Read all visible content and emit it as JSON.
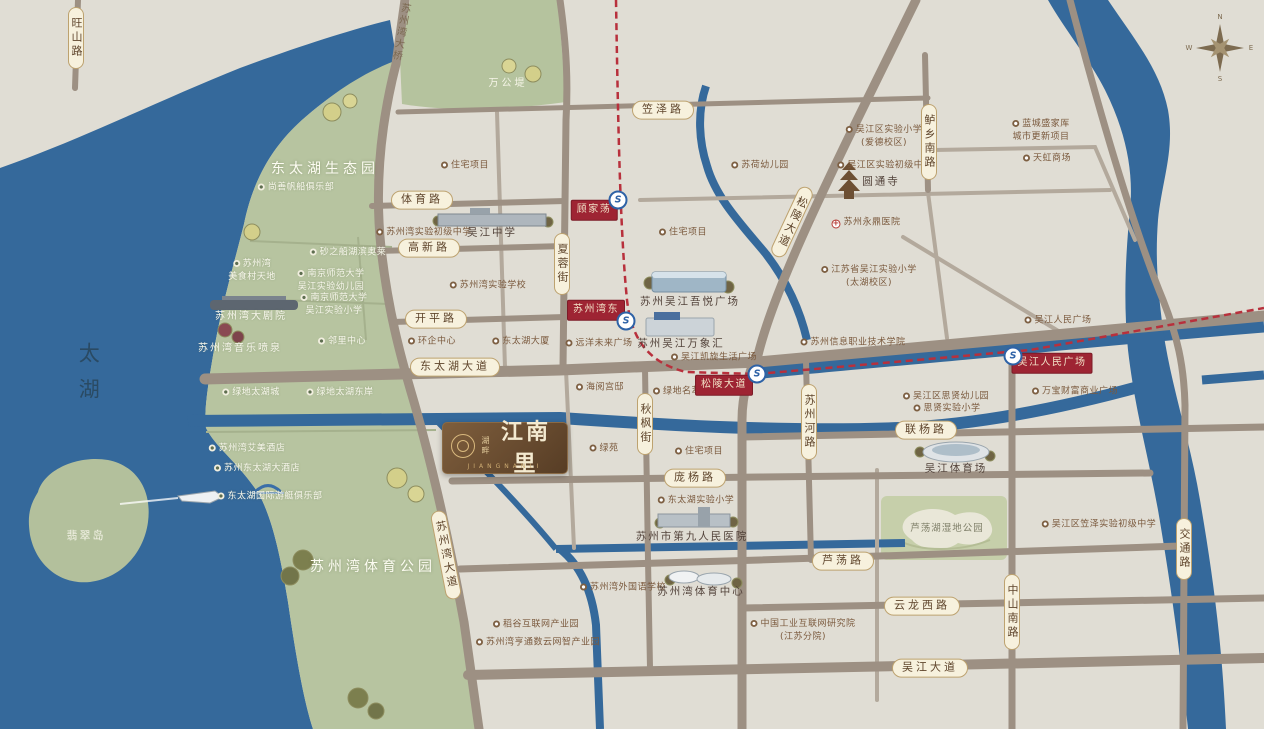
{
  "brand": {
    "prefix": "湖畔",
    "name": "江南里",
    "latin": "JIANGNANLI"
  },
  "compass": {
    "n": "N",
    "e": "E",
    "s": "S",
    "w": "W"
  },
  "colors": {
    "water": "#35699b",
    "land": "#e0ddd4",
    "greenbelt": "#b7c4a0",
    "road": "#9d9083",
    "capsule_bg": "#f7f1dd",
    "badge_red": "#9e2433",
    "metro_blue": "#2e62a6",
    "metro_line_red": "#b8303c",
    "logo_brown": "#6a4c2f"
  },
  "map": {
    "road_capsules": [
      {
        "t": "旺山路",
        "x": 76,
        "y": 38,
        "cls": "v"
      },
      {
        "t": "苏州湾大桥",
        "x": 399,
        "y": 32,
        "cls": "v plain",
        "rot": 10
      },
      {
        "t": "笠泽路",
        "x": 663,
        "y": 110
      },
      {
        "t": "体育路",
        "x": 422,
        "y": 200
      },
      {
        "t": "高新路",
        "x": 429,
        "y": 248
      },
      {
        "t": "开平路",
        "x": 436,
        "y": 319
      },
      {
        "t": "东太湖大道",
        "x": 455,
        "y": 367
      },
      {
        "t": "夏蓉街",
        "x": 562,
        "y": 264,
        "cls": "v"
      },
      {
        "t": "秋枫街",
        "x": 645,
        "y": 424,
        "cls": "v"
      },
      {
        "t": "苏州湾大道",
        "x": 446,
        "y": 555,
        "cls": "v",
        "rot": -11
      },
      {
        "t": "松陵大道",
        "x": 792,
        "y": 222,
        "cls": "v",
        "rot": 25
      },
      {
        "t": "鲈乡南路",
        "x": 929,
        "y": 142,
        "cls": "v"
      },
      {
        "t": "苏州河路",
        "x": 809,
        "y": 422,
        "cls": "v"
      },
      {
        "t": "联杨路",
        "x": 926,
        "y": 430
      },
      {
        "t": "庞杨路",
        "x": 695,
        "y": 478
      },
      {
        "t": "芦荡路",
        "x": 843,
        "y": 561
      },
      {
        "t": "云龙西路",
        "x": 922,
        "y": 606
      },
      {
        "t": "吴江大道",
        "x": 930,
        "y": 668
      },
      {
        "t": "中山南路",
        "x": 1012,
        "y": 612,
        "cls": "v"
      },
      {
        "t": "交通路",
        "x": 1184,
        "y": 549,
        "cls": "v"
      }
    ],
    "metro_stations": [
      {
        "t": "顾家荡",
        "x": 594,
        "y": 210
      },
      {
        "t": "苏州湾东",
        "x": 596,
        "y": 310
      },
      {
        "t": "松陵大道",
        "x": 724,
        "y": 385
      },
      {
        "t": "吴江人民广场",
        "x": 1052,
        "y": 363
      }
    ],
    "metro_icons": [
      {
        "t": "S",
        "x": 618,
        "y": 200
      },
      {
        "t": "S",
        "x": 626,
        "y": 321
      },
      {
        "t": "S",
        "x": 757,
        "y": 374
      },
      {
        "t": "S",
        "x": 1013,
        "y": 356
      }
    ],
    "area_labels": [
      {
        "t": "东太湖生态园",
        "x": 325,
        "y": 169,
        "cls": "big"
      },
      {
        "t": "苏州湾体育公园",
        "x": 373,
        "y": 567,
        "cls": "big"
      },
      {
        "t": "万公堤",
        "x": 508,
        "y": 84,
        "cls": "midw"
      },
      {
        "t": "太湖",
        "x": 88,
        "y": 378,
        "cls": "lake-label"
      },
      {
        "t": "翡翠岛",
        "x": 86,
        "y": 536,
        "cls": "island"
      },
      {
        "t": "芦荡湖湿地公园",
        "x": 947,
        "y": 529,
        "cls": "parktext"
      }
    ],
    "pois": [
      {
        "t": "尚善帆船俱乐部",
        "x": 296,
        "y": 188,
        "cls": "w"
      },
      {
        "t": "苏州湾\n美食村天地",
        "x": 252,
        "y": 271,
        "cls": "w"
      },
      {
        "t": "砂之船湖滨奥莱",
        "x": 348,
        "y": 253,
        "cls": "w"
      },
      {
        "t": "南京师范大学\n吴江实验幼儿园",
        "x": 331,
        "y": 281,
        "cls": "w"
      },
      {
        "t": "南京师范大学\n吴江实验小学",
        "x": 334,
        "y": 305,
        "cls": "w"
      },
      {
        "t": "苏州湾大剧院",
        "x": 251,
        "y": 317,
        "cls": "w nodot md"
      },
      {
        "t": "苏州湾音乐喷泉",
        "x": 240,
        "y": 349,
        "cls": "w nodot md"
      },
      {
        "t": "邻里中心",
        "x": 342,
        "y": 342,
        "cls": "w"
      },
      {
        "t": "绿地太湖城",
        "x": 251,
        "y": 393,
        "cls": "w"
      },
      {
        "t": "绿地太湖东岸",
        "x": 340,
        "y": 393,
        "cls": "w"
      },
      {
        "t": "苏州湾艾美酒店",
        "x": 247,
        "y": 449,
        "cls": "w"
      },
      {
        "t": "苏州东太湖大酒店",
        "x": 257,
        "y": 469,
        "cls": "w"
      },
      {
        "t": "东太湖国际游艇俱乐部",
        "x": 270,
        "y": 497,
        "cls": "w"
      },
      {
        "t": "住宅项目",
        "x": 465,
        "y": 166
      },
      {
        "t": "苏州湾实验初级中学",
        "x": 424,
        "y": 233
      },
      {
        "t": "吴江中学",
        "x": 492,
        "y": 233,
        "cls": "bldg nodot"
      },
      {
        "t": "苏州湾实验学校",
        "x": 488,
        "y": 286
      },
      {
        "t": "环企中心",
        "x": 432,
        "y": 342
      },
      {
        "t": "东太湖大厦",
        "x": 521,
        "y": 342
      },
      {
        "t": "住宅项目",
        "x": 683,
        "y": 233
      },
      {
        "t": "远洋未来广场",
        "x": 599,
        "y": 344
      },
      {
        "t": "苏荷幼儿园",
        "x": 760,
        "y": 166
      },
      {
        "t": "吴江区实验小学\n(爱德校区)",
        "x": 884,
        "y": 137
      },
      {
        "t": "吴江区实验初级中学",
        "x": 885,
        "y": 166
      },
      {
        "t": "圆通寺",
        "x": 881,
        "y": 182,
        "cls": "bldg nodot"
      },
      {
        "t": "苏州永鼎医院",
        "x": 866,
        "y": 223,
        "cls": "hosp"
      },
      {
        "t": "江苏省吴江实验小学\n(太湖校区)",
        "x": 869,
        "y": 277
      },
      {
        "t": "蓝城盛家厍\n城市更新项目",
        "x": 1041,
        "y": 131
      },
      {
        "t": "天虹商场",
        "x": 1047,
        "y": 159
      },
      {
        "t": "苏州吴江吾悦广场",
        "x": 690,
        "y": 302,
        "cls": "bldg nodot"
      },
      {
        "t": "苏州吴江万象汇",
        "x": 681,
        "y": 344,
        "cls": "bldg nodot"
      },
      {
        "t": "吴江凯旋生活广场",
        "x": 714,
        "y": 358
      },
      {
        "t": "苏州信息职业技术学院",
        "x": 853,
        "y": 343
      },
      {
        "t": "吴江人民广场",
        "x": 1058,
        "y": 321
      },
      {
        "t": "万宝财富商业广场",
        "x": 1075,
        "y": 392
      },
      {
        "t": "吴江区思贤幼儿园",
        "x": 946,
        "y": 397
      },
      {
        "t": "思贤实验小学",
        "x": 947,
        "y": 409
      },
      {
        "t": "海阅宫邸",
        "x": 600,
        "y": 388
      },
      {
        "t": "绿地名萃",
        "x": 677,
        "y": 392
      },
      {
        "t": "绿苑",
        "x": 604,
        "y": 449
      },
      {
        "t": "住宅项目",
        "x": 699,
        "y": 452
      },
      {
        "t": "东太湖实验小学",
        "x": 696,
        "y": 501
      },
      {
        "t": "苏州市第九人民医院",
        "x": 692,
        "y": 537,
        "cls": "bldg nodot"
      },
      {
        "t": "苏州湾外国语学校",
        "x": 623,
        "y": 588
      },
      {
        "t": "苏州湾体育中心",
        "x": 701,
        "y": 592,
        "cls": "bldg nodot"
      },
      {
        "t": "吴江体育场",
        "x": 956,
        "y": 469,
        "cls": "bldg nodot"
      },
      {
        "t": "吴江区笠泽实验初级中学",
        "x": 1099,
        "y": 525
      },
      {
        "t": "稻谷互联网产业园",
        "x": 536,
        "y": 625
      },
      {
        "t": "苏州湾亨通数云网智产业园",
        "x": 538,
        "y": 643
      },
      {
        "t": "中国工业互联网研究院\n(江苏分院)",
        "x": 803,
        "y": 631
      }
    ]
  }
}
